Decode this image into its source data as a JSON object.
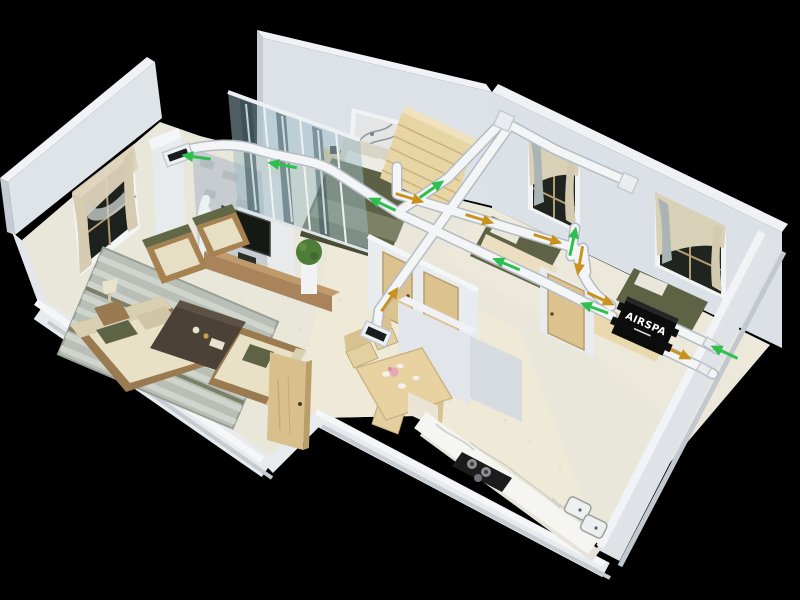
{
  "scene": {
    "description": "3D isometric cutaway rendering of an apartment showing a ducted fresh-air ventilation system",
    "background_color": "#000000"
  },
  "unit": {
    "label": "AIRSPA",
    "body_color": "#0c0c0c",
    "text_color": "#ffffff"
  },
  "colors": {
    "supply_arrow": "#2fbf4e",
    "return_arrow": "#c9921f",
    "duct": "#f3f5f7",
    "duct_shadow": "#b4bcc4",
    "wall_top": "#f0f2f5",
    "wall_face": "#dde2e7",
    "floor_cream": "#efe9d7"
  },
  "airflow": {
    "arrows": [
      {
        "x": 196,
        "y": 157,
        "a": 188,
        "t": "s"
      },
      {
        "x": 282,
        "y": 165,
        "a": 190,
        "t": "s"
      },
      {
        "x": 382,
        "y": 204,
        "a": 205,
        "t": "s"
      },
      {
        "x": 432,
        "y": 189,
        "a": -35,
        "t": "s"
      },
      {
        "x": 573,
        "y": 241,
        "a": -78,
        "t": "s"
      },
      {
        "x": 506,
        "y": 264,
        "a": 203,
        "t": "s"
      },
      {
        "x": 594,
        "y": 308,
        "a": 200,
        "t": "s"
      },
      {
        "x": 724,
        "y": 352,
        "a": 205,
        "t": "s"
      },
      {
        "x": 410,
        "y": 198,
        "a": 17,
        "t": "r"
      },
      {
        "x": 480,
        "y": 219,
        "a": 17,
        "t": "r"
      },
      {
        "x": 548,
        "y": 239,
        "a": 17,
        "t": "r"
      },
      {
        "x": 580,
        "y": 261,
        "a": 100,
        "t": "r"
      },
      {
        "x": 601,
        "y": 299,
        "a": 25,
        "t": "r"
      },
      {
        "x": 678,
        "y": 353,
        "a": 25,
        "t": "r"
      },
      {
        "x": 390,
        "y": 299,
        "a": -55,
        "t": "r"
      }
    ]
  },
  "ducts": {
    "segments": [
      "M178,152 C210,143 238,143 258,150 C290,160 312,158 335,172 L400,214 L470,247 L542,281 L612,316",
      "M397,167 L397,194 L575,248 L583,274 C592,292 600,299 611,306",
      "M376,334 L379,310 L508,128",
      "M398,212 L448,178 L500,124",
      "M512,126 L556,150 L624,180",
      "M571,256 L575,228",
      "M583,248 L586,272",
      "M668,325 L704,342",
      "M706,343 L717,349",
      "M660,348 L700,367",
      "M702,368 L713,374"
    ],
    "fittings": [
      {
        "x": 504,
        "y": 121,
        "a": 24,
        "w": 16,
        "h": 16
      },
      {
        "x": 628,
        "y": 183,
        "a": 24,
        "w": 16,
        "h": 16
      },
      {
        "x": 710,
        "y": 344,
        "a": 30,
        "w": 12,
        "h": 9
      },
      {
        "x": 704,
        "y": 369,
        "a": 30,
        "w": 12,
        "h": 9
      }
    ],
    "grilles": [
      {
        "x": 178,
        "y": 155,
        "a": -20,
        "w": 28,
        "h": 15
      },
      {
        "x": 376,
        "y": 334,
        "a": 24,
        "w": 28,
        "h": 16
      }
    ]
  }
}
